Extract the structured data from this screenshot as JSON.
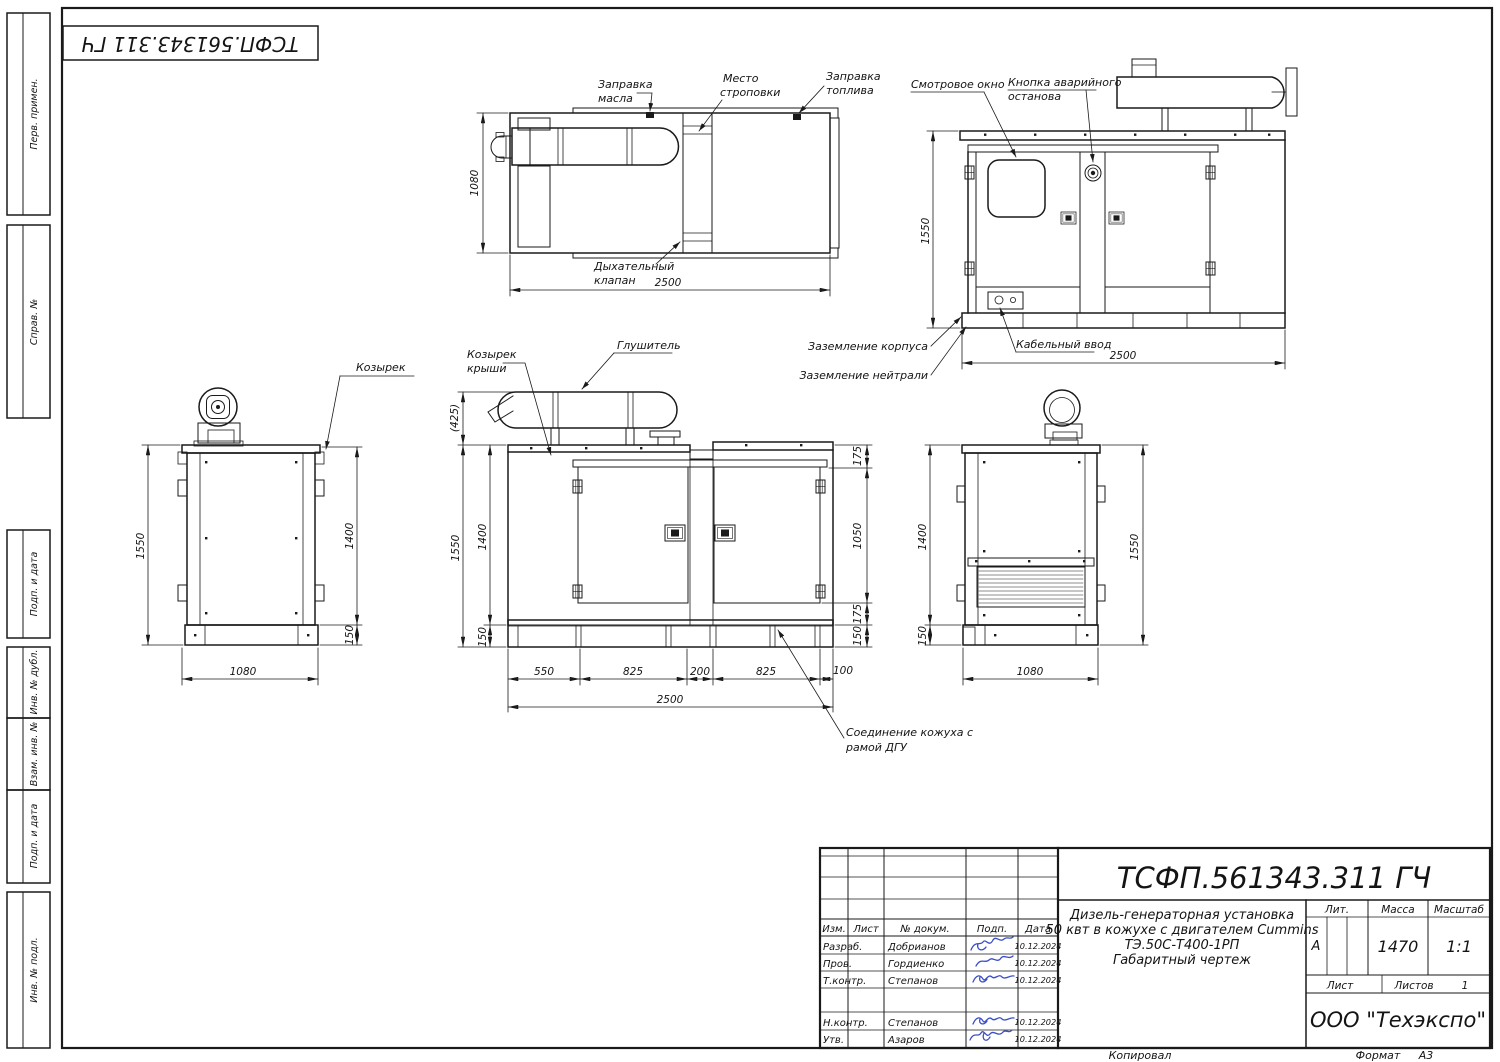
{
  "stamp_top": "ТСФП.561343.311 ГЧ",
  "margin_labels": {
    "perv_primen": "Перв. примен.",
    "sprav_no": "Справ. №",
    "podp_data_1": "Подп. и дата",
    "inv_dubl": "Инв. № дубл.",
    "vzam_inv": "Взам. инв. №",
    "podp_data_2": "Подп. и дата",
    "inv_podl": "Инв. № подл."
  },
  "plan_view": {
    "label_oil_1": "Заправка",
    "label_oil_2": "масла",
    "label_sling_1": "Место",
    "label_sling_2": "строповки",
    "label_fuel_1": "Заправка",
    "label_fuel_2": "топлива",
    "label_breather_1": "Дыхательный",
    "label_breather_2": "клапан",
    "dim_width": "1080",
    "dim_length": "2500"
  },
  "side_view": {
    "label_window": "Смотровое окно",
    "label_estop_1": "Кнопка аварийного",
    "label_estop_2": "останова",
    "label_ground_body": "Заземление корпуса",
    "label_cable": "Кабельный ввод",
    "label_ground_neutral": "Заземление нейтрали",
    "dim_height": "1550",
    "dim_length": "2500"
  },
  "left_view": {
    "label_visor": "Козырек",
    "dim_height": "1550",
    "dim_body": "1400",
    "dim_skid": "150",
    "dim_width": "1080"
  },
  "front_view": {
    "label_roof_visor_1": "Козырек",
    "label_roof_visor_2": "крыши",
    "label_muffler": "Глушитель",
    "label_joint_1": "Соединение кожуха с",
    "label_joint_2": "рамой ДГУ",
    "dim_muffler": "(425)",
    "dim_height": "1550",
    "dim_body": "1400",
    "dim_skid_left": "150",
    "dim_top_offset": "175",
    "dim_door": "1050",
    "dim_bottom_offset": "175",
    "dim_skid_right": "150",
    "dim_b1": "550",
    "dim_b2": "825",
    "dim_b3": "200",
    "dim_b4": "825",
    "dim_b5": "100",
    "dim_length": "2500"
  },
  "right_view": {
    "dim_body": "1400",
    "dim_skid": "150",
    "dim_height": "1550",
    "dim_width": "1080"
  },
  "title_block": {
    "designation": "ТСФП.561343.311 ГЧ",
    "desc_1": "Дизель-генераторная установка",
    "desc_2": "50 квт в кожухе с двигателем Cummins",
    "desc_3": "ТЭ.50С-Т400-1РП",
    "desc_4": "Габаритный чертеж",
    "col_izm": "Изм.",
    "col_list": "Лист",
    "col_doc": "№ докум.",
    "col_sign": "Подп.",
    "col_date": "Дата",
    "rows": [
      {
        "role": "Разраб.",
        "name": "Добрианов",
        "date": "10.12.2024"
      },
      {
        "role": "Пров.",
        "name": "Гордиенко",
        "date": "10.12.2024"
      },
      {
        "role": "Т.контр.",
        "name": "Степанов",
        "date": "10.12.2024"
      },
      {
        "role": "Н.контр.",
        "name": "Степанов",
        "date": "10.12.2024"
      },
      {
        "role": "Утв.",
        "name": "Азаров",
        "date": "10.12.2024"
      }
    ],
    "lit_label": "Лит.",
    "lit_value": "А",
    "mass_label": "Масса",
    "mass_value": "1470",
    "scale_label": "Масштаб",
    "scale_value": "1:1",
    "sheet_label": "Лист",
    "sheets_label": "Листов",
    "sheets_value": "1",
    "company": "ООО \"Техэкспо\""
  },
  "footer": {
    "copied": "Копировал",
    "format_label": "Формат",
    "format_value": "А3"
  }
}
